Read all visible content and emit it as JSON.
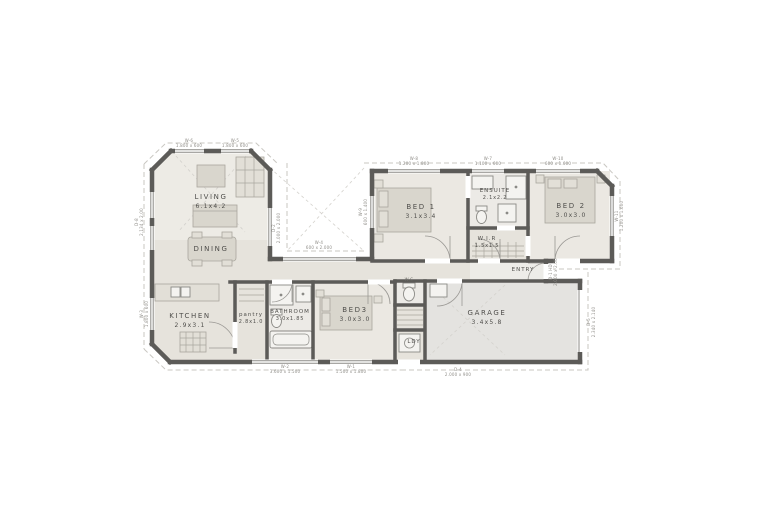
{
  "plan": {
    "title": "single-storey house floor plan",
    "colors": {
      "background": "#ffffff",
      "wall": "#5c5b58",
      "floor": "#e6e3dc",
      "floor_light": "#edebe5",
      "garage_floor": "#e4e3e0",
      "wet_area": "#eceae6",
      "furniture": "#d9d6cd",
      "eaves_dash": "#c9c7c2",
      "label_text": "#4f4e4b",
      "dim_text": "#8f8d88"
    },
    "rooms": {
      "living": {
        "name": "LIVING",
        "size": "6.1x4.2"
      },
      "dining": {
        "name": "DINING",
        "size": ""
      },
      "kitchen": {
        "name": "KITCHEN",
        "size": "2.9x3.1"
      },
      "pantry": {
        "name": "pantry",
        "size": "2.8x1.0"
      },
      "bathroom": {
        "name": "BATHROOM",
        "size": "3.0x1.85"
      },
      "bed3": {
        "name": "BED3",
        "size": "3.0x3.0"
      },
      "bed1": {
        "name": "BED 1",
        "size": "3.1x3.4"
      },
      "ensuite": {
        "name": "ENSUITE",
        "size": "2.1x2.2"
      },
      "wir": {
        "name": "W.I.R",
        "size": "1.5x1.5"
      },
      "bed2": {
        "name": "BED 2",
        "size": "3.0x3.0"
      },
      "entry": {
        "name": "ENTRY",
        "size": ""
      },
      "garage": {
        "name": "GARAGE",
        "size": "3.4x5.8"
      },
      "ldy": {
        "name": "LDY",
        "size": ""
      },
      "wc": {
        "name": "W.C",
        "size": ""
      }
    },
    "openings": {
      "w6": {
        "code": "W-6",
        "size": "1.800 x 600"
      },
      "w5": {
        "code": "W-5",
        "size": "1.800 x 600"
      },
      "w8": {
        "code": "W-8",
        "size": "1.200 x 1.800"
      },
      "w7": {
        "code": "W-7",
        "size": "1.100 x 600"
      },
      "w10": {
        "code": "W-10",
        "size": "600 x 1.600"
      },
      "w4": {
        "code": "W-4",
        "size": "600 x 2.000"
      },
      "w2": {
        "code": "W-2",
        "size": "3.600 x 1.500"
      },
      "w1": {
        "code": "W-1",
        "size": "1.500 x 1.800"
      },
      "d4": {
        "code": "D-4",
        "size": "2.000 x 900"
      },
      "d8": {
        "code": "D-8",
        "size": "2.134 x 2.00"
      },
      "w3": {
        "code": "W-3",
        "size": "1.800 x 600"
      },
      "w9": {
        "code": "W-9",
        "size": "600 x 1.400"
      },
      "w11": {
        "code": "W-11",
        "size": "1.200 x 1.600"
      },
      "d1": {
        "code": "D-1 HD",
        "size": "2.000 x 2.00"
      },
      "d5": {
        "code": "D-5",
        "size": "2.340 x 2.140"
      },
      "d2": {
        "code": "D-2",
        "size": "2.000 x 2.000"
      }
    }
  }
}
